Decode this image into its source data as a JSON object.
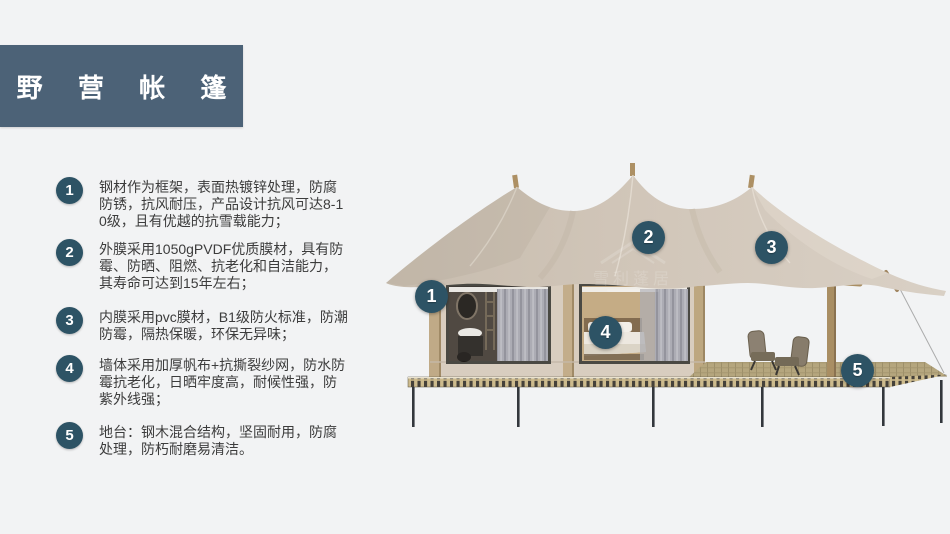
{
  "header": {
    "title": "野 营 帐 篷"
  },
  "colors": {
    "accent": "#2d5365",
    "title_bar": "#4c6277",
    "background": "#f2f3f4",
    "canvas_tent": "#d2c7ba",
    "deck_wood": "#c9b88c"
  },
  "features": [
    {
      "num": "1",
      "text": "钢材作为框架，表面热镀锌处理，防腐防锈，抗风耐压，产品设计抗风可达8-10级，且有优越的抗雪载能力；"
    },
    {
      "num": "2",
      "text": "外膜采用1050gPVDF优质膜材，具有防霉、防晒、阻燃、抗老化和自洁能力，其寿命可达到15年左右；"
    },
    {
      "num": "3",
      "text": "内膜采用pvc膜材，B1级防火标准，防潮防霉，隔热保暖，环保无异味；"
    },
    {
      "num": "4",
      "text": "墙体采用加厚帆布+抗撕裂纱网，防水防霉抗老化，日晒牢度高，耐候性强，防紫外线强；"
    },
    {
      "num": "5",
      "text": "地台：钢木混合结构，坚固耐用，防腐处理，防朽耐磨易清洁。"
    }
  ],
  "illustration": {
    "watermark": "雪利蓬居",
    "callouts": [
      {
        "num": "1"
      },
      {
        "num": "2"
      },
      {
        "num": "3"
      },
      {
        "num": "4"
      },
      {
        "num": "5"
      }
    ]
  }
}
